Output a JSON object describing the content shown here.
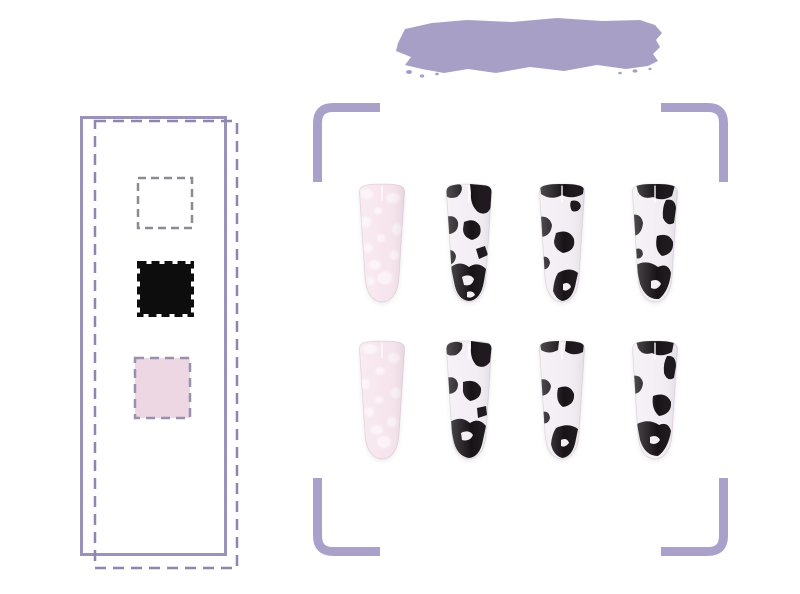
{
  "page": {
    "background": "#ffffff",
    "subject": "cow-print press-on nails product showcase"
  },
  "colors": {
    "brush": "#a89fc6",
    "frame_solid": "#9a92b8",
    "frame_dashed": "#8e86ae",
    "swatch_white_fill": "#ffffff",
    "swatch_white_border": "#8b8b95",
    "swatch_black": "#0d0d0d",
    "swatch_pink_fill": "#ecd7e3",
    "swatch_pink_border": "#9a90ae",
    "bracket": "#a9a1c9",
    "cow_base": "#f3eef4",
    "cow_spot": "#171317",
    "pink_base": "#f7e5ee",
    "pink_spot": "#fdf5f8",
    "gloss": "#ffffff"
  },
  "palette": {
    "swatches": [
      {
        "name": "white",
        "fill": "#ffffff",
        "border_style": "dashed"
      },
      {
        "name": "black",
        "fill": "#0d0d0d",
        "border_style": "dashed"
      },
      {
        "name": "pink",
        "fill": "#ecd7e3",
        "border_style": "dashed"
      }
    ]
  },
  "nail_display": {
    "rows": 2,
    "columns": 4,
    "items": [
      {
        "row": 1,
        "col": 1,
        "style": "pink-marble"
      },
      {
        "row": 1,
        "col": 2,
        "style": "cow-print"
      },
      {
        "row": 1,
        "col": 3,
        "style": "cow-print"
      },
      {
        "row": 1,
        "col": 4,
        "style": "cow-print"
      },
      {
        "row": 2,
        "col": 1,
        "style": "pink-marble"
      },
      {
        "row": 2,
        "col": 2,
        "style": "cow-print"
      },
      {
        "row": 2,
        "col": 3,
        "style": "cow-print"
      },
      {
        "row": 2,
        "col": 4,
        "style": "cow-print"
      }
    ]
  }
}
